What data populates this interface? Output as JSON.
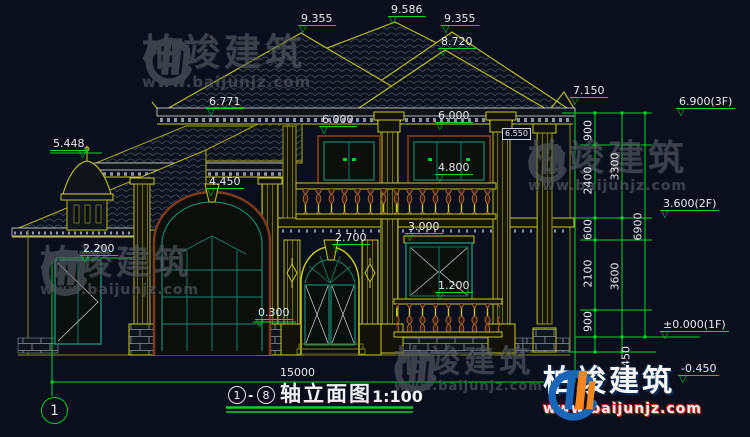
{
  "title": {
    "axis_start": "1",
    "axis_end": "8",
    "dash": "-",
    "name": "轴立面图",
    "scale": "1:100",
    "axis_bubble": "1"
  },
  "levels": {
    "roof_left": "9.355",
    "ridge_main": "9.586",
    "roof_right": "9.355",
    "ridge_front": "8.720",
    "eave_right": "7.150",
    "floor3": "6.900(3F)",
    "eave_left": "6.771",
    "win2f_left_head": "6.000",
    "win2f_right_head": "6.000",
    "capital": "6.550",
    "turret_top": "5.448",
    "balcony_rail": "4.800",
    "arch_top": "4.450",
    "floor2": "3.600(2F)",
    "win1f_head": "3.000",
    "door_arch": "2.700",
    "porch_door_head": "2.200",
    "win1f_rail": "1.200",
    "plinth": "0.300",
    "floor1": "±0.000(1F)",
    "ground": "-0.450"
  },
  "dims": {
    "seg_900_top": "900",
    "seg_2400": "2400",
    "seg_600": "600",
    "seg_2100": "2100",
    "seg_900_bottom": "900",
    "seg_450": "450",
    "sum_3300": "3300",
    "sum_3600": "3600",
    "sum_6900": "6900",
    "total_width": "15000"
  },
  "watermark": {
    "brand": "柏竣建筑",
    "url": "www.baijunjz.com"
  },
  "colors": {
    "background": "#0b0f1d",
    "dimension_green": "#00d42a",
    "building_yellow": "#c8c81e",
    "window_teal": "#1d8573",
    "baluster_brown": "#a8622c",
    "logo_blue": "#1766b8",
    "logo_orange": "#f5861f"
  }
}
